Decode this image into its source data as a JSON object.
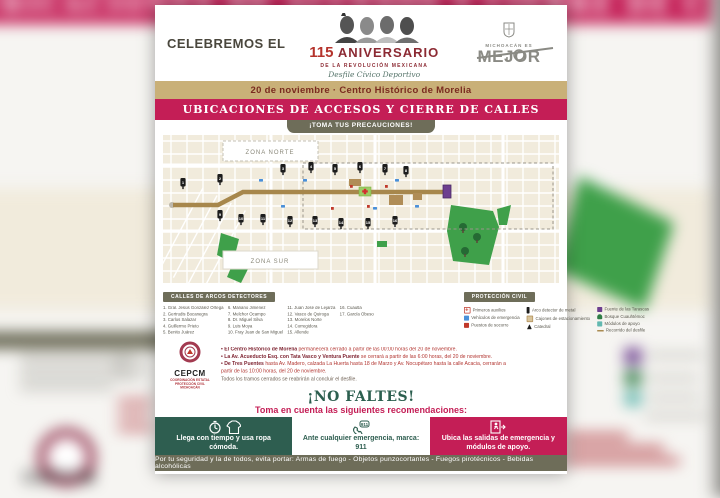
{
  "background": {
    "banner_text": "UBICACIONES DE ACCESOS Y CIERRE DE CALLES",
    "cepcm_text": "CEPCM"
  },
  "header": {
    "celebremos": "CELEBREMOS EL",
    "num": "115",
    "aniversario": "ANIVERSARIO",
    "sub": "DE LA REVOLUCIÓN MEXICANA",
    "script": "Desfile Cívico Deportivo",
    "brand_top": "MICHOACÁN ES",
    "brand": "MEJOR"
  },
  "date_bar": "20 de noviembre · Centro Histórico de Morelia",
  "banner": "UBICACIONES DE ACCESOS Y CIERRE DE CALLES",
  "precaution_tab": "¡TOMA TUS PRECAUCIONES!",
  "map": {
    "zona_norte": "ZONA NORTE",
    "zona_sur": "ZONA SUR",
    "pins": [
      {
        "n": "1",
        "x": 20,
        "y": 48
      },
      {
        "n": "2",
        "x": 57,
        "y": 44
      },
      {
        "n": "3",
        "x": 120,
        "y": 34
      },
      {
        "n": "4",
        "x": 148,
        "y": 32
      },
      {
        "n": "5",
        "x": 172,
        "y": 34
      },
      {
        "n": "6",
        "x": 197,
        "y": 32
      },
      {
        "n": "7",
        "x": 222,
        "y": 34
      },
      {
        "n": "8",
        "x": 243,
        "y": 36
      },
      {
        "n": "9",
        "x": 57,
        "y": 80
      },
      {
        "n": "10",
        "x": 78,
        "y": 84
      },
      {
        "n": "11",
        "x": 100,
        "y": 84
      },
      {
        "n": "12",
        "x": 127,
        "y": 86
      },
      {
        "n": "13",
        "x": 152,
        "y": 86
      },
      {
        "n": "14",
        "x": 178,
        "y": 88
      },
      {
        "n": "15",
        "x": 205,
        "y": 88
      },
      {
        "n": "16",
        "x": 232,
        "y": 86
      }
    ],
    "cars": [
      [
        96,
        44
      ],
      [
        140,
        44
      ],
      [
        232,
        44
      ],
      [
        118,
        70
      ],
      [
        210,
        72
      ],
      [
        252,
        70
      ]
    ],
    "aids": [
      [
        187,
        50
      ],
      [
        204,
        70
      ],
      [
        222,
        50
      ],
      [
        168,
        72
      ]
    ]
  },
  "legend_streets": {
    "title": "CALLES DE ARCOS DETECTORES",
    "columns": [
      [
        "1. Gral. Jesús González Ortega",
        "2. Gertrudis Bocanegra",
        "3. Carlos Salazar",
        "4. Guillermo Prieto",
        "5. Benito Juárez"
      ],
      [
        "6. Mariano Jiménez",
        "7. Melchor Ocampo",
        "8. Dr. Miguel Silva",
        "9. Luis Moya",
        "10. Fray Juan de San Miguel"
      ],
      [
        "11. Juan José de Lejarza",
        "12. Vasco de Quiroga",
        "13. Morelos Norte",
        "14. Corregidora",
        "15. Allende"
      ],
      [
        "16. Cuautla",
        "17. García Obeso"
      ]
    ]
  },
  "legend_pc": {
    "title": "PROTECCIÓN CIVIL",
    "columns": [
      [
        {
          "icon": "first-aid",
          "label": "Primeros auxilios"
        },
        {
          "icon": "ambulance",
          "label": "Vehículos de emergencia"
        },
        {
          "icon": "rescue",
          "label": "Puestos de socorro"
        }
      ],
      [
        {
          "icon": "metal-arch",
          "label": "Arco detector de metal"
        },
        {
          "icon": "parking",
          "label": "Cajones de estacionamiento"
        },
        {
          "icon": "cathedral",
          "label": "Catedral"
        }
      ],
      [
        {
          "icon": "fountain",
          "label": "Fuente de las Tarascas"
        },
        {
          "icon": "park",
          "label": "Bosque Cuauhtémoc"
        },
        {
          "icon": "modules",
          "label": "Módulos de apoyo"
        },
        {
          "icon": "route-dash",
          "label": "Recorrido del desfile"
        }
      ]
    ]
  },
  "cepcm": {
    "name": "CEPCM",
    "line1": "COORDINACIÓN ESTATAL",
    "line2": "PROTECCIÓN CIVIL MICHOACÁN"
  },
  "notes": {
    "items": [
      {
        "lead": "• El Centro Histórico de Morelia",
        "rest": " permanecerá cerrado a partir de las 00:00 horas del 20 de noviembre."
      },
      {
        "lead": "• La Av. Acueducto Esq. con Tata Vasco y Ventura Puente",
        "rest": " se cerrará a partir de las 6:00 horas, del 20 de noviembre."
      },
      {
        "lead": "• De Tres Puentes",
        "rest": " hasta Av. Madero, calzada La Huerta hasta 18 de Marzo y Av. Nocupétaro hasta la calle Acacia, cerrarán a partir de las 10:00 horas, del 20 de noviembre."
      }
    ],
    "footer": "Todos los tramos cerrados se reabrirán al concluir el desfile."
  },
  "no_faltes": {
    "title": "¡NO FALTES!",
    "subtitle": "Toma en cuenta las siguientes recomendaciones:"
  },
  "recommendations": [
    {
      "text": "Llega con tiempo y usa ropa cómoda.",
      "style": "teal"
    },
    {
      "text": "Ante cualquier emergencia, marca: 911",
      "style": "white"
    },
    {
      "text": "Ubica las salidas de emergencia y módulos de apoyo.",
      "style": "crimson"
    }
  ],
  "bottom_bar": "Por tu seguridad y la de todos, evita portar: Armas de fuego - Objetos punzocortantes - Fuegos pirotécnicos - Bebidas alcohólicas",
  "colors": {
    "crimson": "#c41e56",
    "olive": "#6e6d59",
    "teal": "#2e5e50",
    "tan": "#c9b078",
    "map_cream": "#f1ebdc",
    "park_green": "#3fa04a",
    "route_brown": "#a7874c",
    "note_red": "#b23530",
    "maroon": "#8c2a33"
  }
}
